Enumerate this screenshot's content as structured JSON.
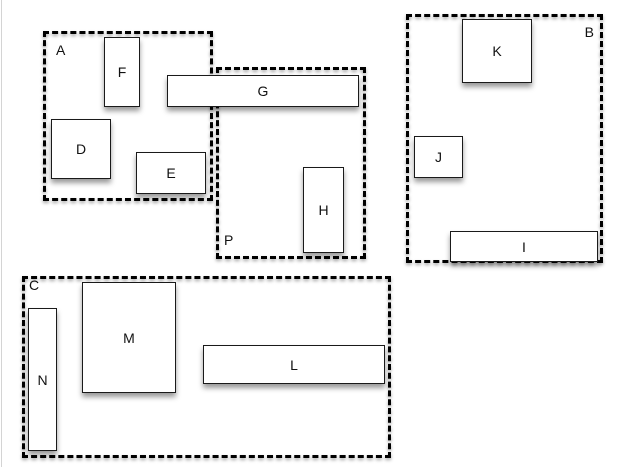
{
  "diagram": {
    "colors": {
      "background": "#ffffff",
      "line": "#000000",
      "shape_fill": "#ffffff",
      "text": "#111111"
    },
    "groups": [
      {
        "id": "A",
        "label": "A"
      },
      {
        "id": "B",
        "label": "B"
      },
      {
        "id": "C",
        "label": "C"
      },
      {
        "id": "P",
        "label": "P"
      }
    ],
    "boxes": [
      {
        "id": "F",
        "label": "F"
      },
      {
        "id": "G",
        "label": "G"
      },
      {
        "id": "D",
        "label": "D"
      },
      {
        "id": "E",
        "label": "E"
      },
      {
        "id": "H",
        "label": "H"
      },
      {
        "id": "K",
        "label": "K"
      },
      {
        "id": "J",
        "label": "J"
      },
      {
        "id": "I",
        "label": "I"
      },
      {
        "id": "M",
        "label": "M"
      },
      {
        "id": "N",
        "label": "N"
      },
      {
        "id": "L",
        "label": "L"
      }
    ]
  }
}
